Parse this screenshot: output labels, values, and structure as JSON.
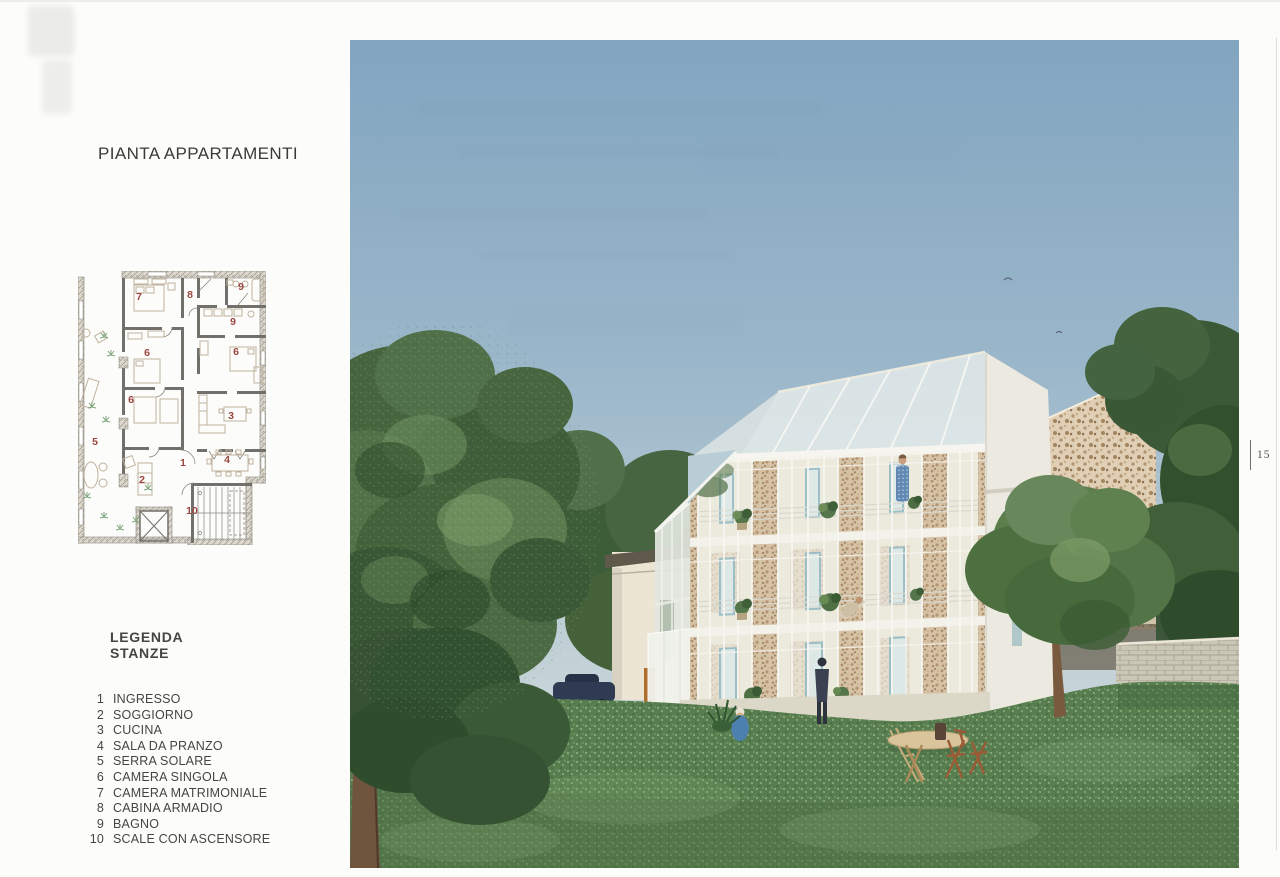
{
  "page": {
    "title": "PIANTA APPARTAMENTI",
    "page_number": "15"
  },
  "legend": {
    "heading_line1": "LEGENDA",
    "heading_line2": "STANZE",
    "items": [
      {
        "num": "1",
        "label": "INGRESSO"
      },
      {
        "num": "2",
        "label": "SOGGIORNO"
      },
      {
        "num": "3",
        "label": "CUCINA"
      },
      {
        "num": "4",
        "label": "SALA DA PRANZO"
      },
      {
        "num": "5",
        "label": "SERRA SOLARE"
      },
      {
        "num": "6",
        "label": "CAMERA SINGOLA"
      },
      {
        "num": "7",
        "label": "CAMERA MATRIMONIALE"
      },
      {
        "num": "8",
        "label": "CABINA ARMADIO"
      },
      {
        "num": "9",
        "label": "BAGNO"
      },
      {
        "num": "10",
        "label": "SCALE CON ASCENSORE"
      }
    ]
  },
  "floor_plan": {
    "room_labels": [
      {
        "num": "7",
        "x": 61,
        "y": 29
      },
      {
        "num": "8",
        "x": 112,
        "y": 27
      },
      {
        "num": "9",
        "x": 163,
        "y": 19
      },
      {
        "num": "9",
        "x": 155,
        "y": 54
      },
      {
        "num": "6",
        "x": 69,
        "y": 85
      },
      {
        "num": "6",
        "x": 158,
        "y": 84
      },
      {
        "num": "6",
        "x": 53,
        "y": 132
      },
      {
        "num": "3",
        "x": 153,
        "y": 148
      },
      {
        "num": "5",
        "x": 17,
        "y": 174
      },
      {
        "num": "1",
        "x": 105,
        "y": 195
      },
      {
        "num": "2",
        "x": 64,
        "y": 212
      },
      {
        "num": "4",
        "x": 149,
        "y": 192
      },
      {
        "num": "10",
        "x": 114,
        "y": 243
      }
    ]
  },
  "colors": {
    "accent_red": "#9b4540",
    "sky_top": "#82a5c0",
    "sky_bottom": "#d2dcdc",
    "grass": "#587e50",
    "stone": "#d6c2a4",
    "glass": "#eef0ea",
    "teal_frame": "#5795a6"
  }
}
